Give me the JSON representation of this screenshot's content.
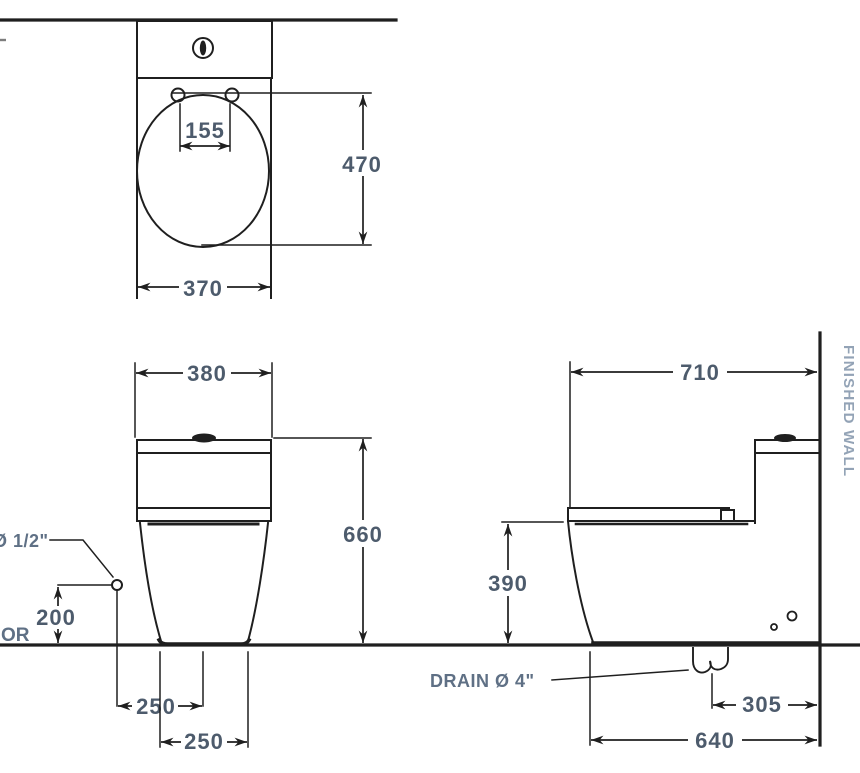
{
  "drawing": {
    "type": "technical dimension drawing",
    "subject": "one-piece toilet installation drawing: plan view, front elevation and side elevation with millimetre dimensions"
  },
  "colors": {
    "line": "#1f1f1f",
    "dim_text": "#4d5b6c",
    "label_text": "#5f7085",
    "wall_text": "#93a3b6",
    "background": "#ffffff"
  },
  "plan_view": {
    "dim_hinge_spacing": "155",
    "dim_seat_length": "470",
    "dim_width": "370"
  },
  "front_view": {
    "dim_tank_width": "380",
    "dim_height": "660",
    "dim_supply_height": "200",
    "dim_supply_offset": "250",
    "dim_base_width": "250",
    "label_supply": "Ø 1/2\"",
    "label_floor_partial": "OR"
  },
  "side_view": {
    "dim_depth": "710",
    "dim_seat_height": "390",
    "dim_drain_offset": "305",
    "dim_base_depth": "640",
    "label_drain": "DRAIN Ø 4\"",
    "label_wall": "FINISHED WALL"
  }
}
